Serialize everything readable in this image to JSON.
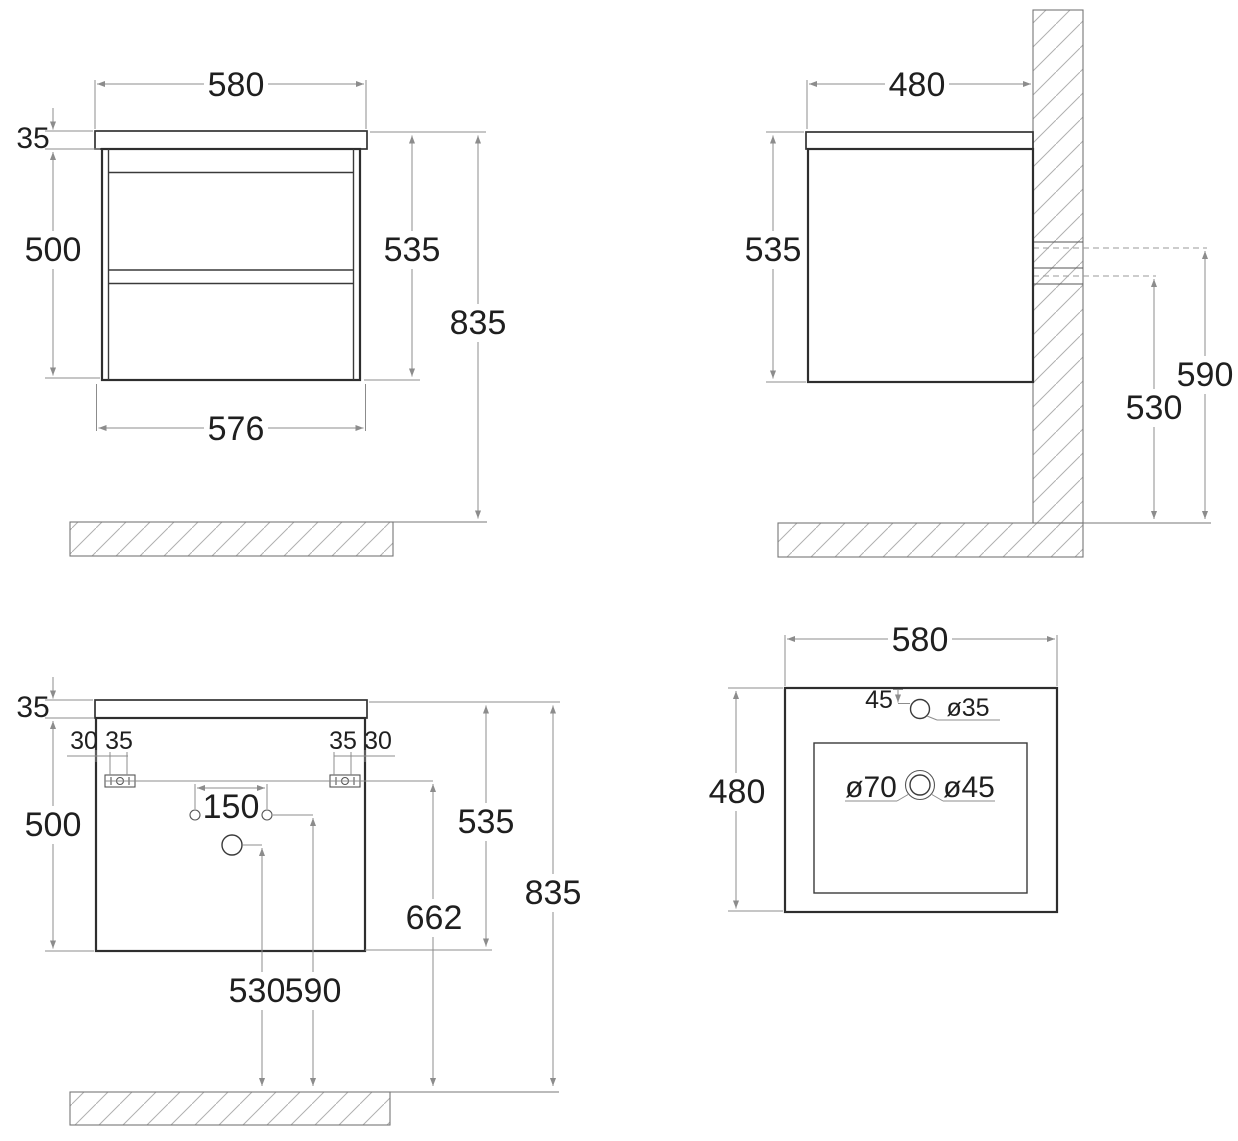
{
  "colors": {
    "background": "#ffffff",
    "outline": "#2e2e2e",
    "dimension_lines": "#8c8c8c",
    "text": "#1f1f1f",
    "hatch": "#b0b0b0"
  },
  "views": {
    "front": {
      "width_top": "580",
      "counter_thickness": "35",
      "body_height": "500",
      "carcass_height": "535",
      "total_height": "835",
      "width_bottom": "576"
    },
    "side": {
      "depth": "480",
      "carcass_height": "535",
      "upper_fixing_height": "590",
      "lower_fixing_height": "530"
    },
    "rear": {
      "counter_thickness": "35",
      "fixing_offset_left": "30",
      "fixing_width_left": "35",
      "fixing_width_right": "35",
      "fixing_offset_right": "30",
      "tap_holes_spacing": "150",
      "body_height": "500",
      "carcass_height": "535",
      "fixing_height": "662",
      "total_height": "835",
      "drain_hole_height": "530",
      "tap_holes_height": "590"
    },
    "top": {
      "width": "580",
      "depth": "480",
      "tap_hole_offset": "45",
      "tap_hole_diameter": "ø35",
      "drain_recess_diameter": "ø70",
      "drain_hole_diameter": "ø45"
    }
  }
}
